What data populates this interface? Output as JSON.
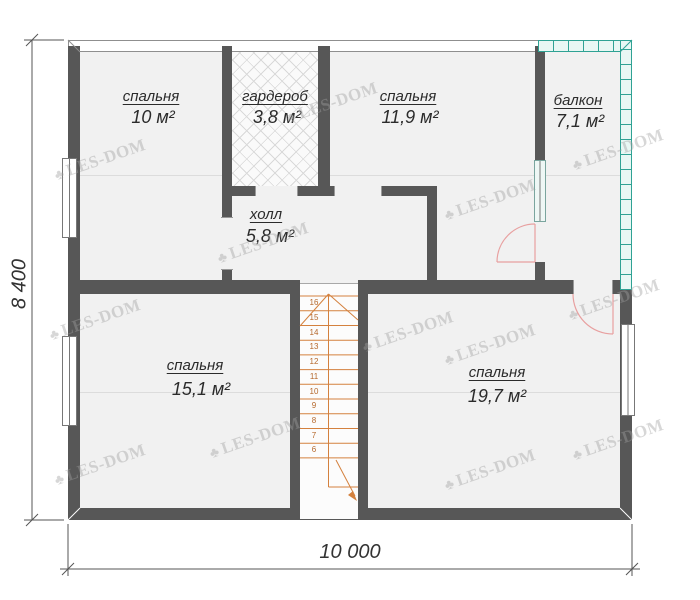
{
  "rooms": [
    {
      "id": "bedroom-top-left",
      "name": "спальня",
      "area": "10 м²"
    },
    {
      "id": "wardrobe",
      "name": "гардероб",
      "area": "3,8 м²"
    },
    {
      "id": "bedroom-top-right",
      "name": "спальня",
      "area": "11,9 м²"
    },
    {
      "id": "balcony",
      "name": "балкон",
      "area": "7,1 м²"
    },
    {
      "id": "hall",
      "name": "холл",
      "area": "5,8 м²"
    },
    {
      "id": "bedroom-bottom-left",
      "name": "спальня",
      "area": "15,1 м²"
    },
    {
      "id": "bedroom-bottom-right",
      "name": "спальня",
      "area": "19,7 м²"
    }
  ],
  "dimensions": {
    "height_label": "8 400",
    "width_label": "10 000"
  },
  "stairs": {
    "steps": [
      "16",
      "15",
      "14",
      "13",
      "12",
      "11",
      "10",
      "9",
      "8",
      "7",
      "6"
    ]
  },
  "watermark": {
    "icon": "♣",
    "text": "LES-DOM"
  },
  "colors": {
    "wall": "#575757",
    "balcony_wall": "#2fa294",
    "stair_lines": "#d4813e",
    "door_arc": "#e8a0a0",
    "room_fill": "#f1f1f1"
  }
}
